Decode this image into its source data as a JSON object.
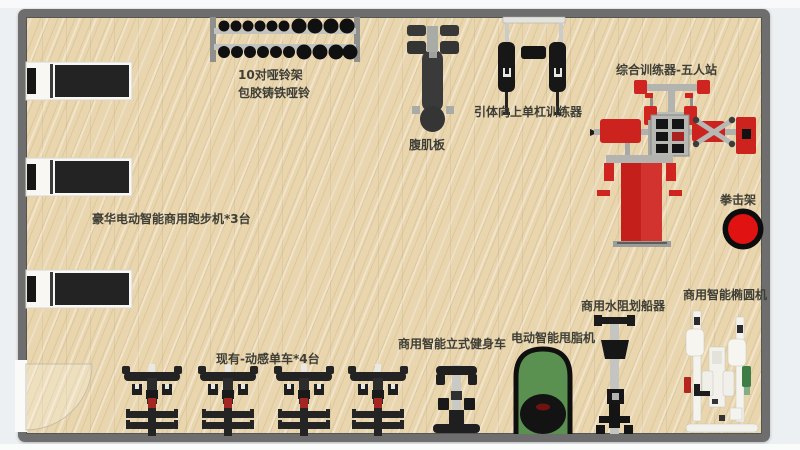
{
  "colors": {
    "floor": "#e9d6ae",
    "wall": "#6e6e6e",
    "machine_red": "#cc231f",
    "machine_green": "#5a9150",
    "machine_black": "#1a1a1a",
    "label_text": "#3e3e36",
    "outside": "#edf0f2"
  },
  "equipment": {
    "treadmills": {
      "label": "豪华电动智能商用跑步机*3台",
      "count": 3
    },
    "dumbbell_rack": {
      "label_line1": "10对哑铃架",
      "label_line2": "包胶铸铁哑铃",
      "pairs": 10
    },
    "ab_board": {
      "label": "腹肌板"
    },
    "pullup_trainer": {
      "label": "引体向上单杠训练器"
    },
    "multi_station": {
      "label": "综合训练器-五人站",
      "stations": 5
    },
    "boxing_rack": {
      "label": "拳击架"
    },
    "spin_bikes": {
      "label": "现有-动感单车*4台",
      "count": 4
    },
    "upright_bike": {
      "label": "商用智能立式健身车"
    },
    "fat_shaker": {
      "label": "电动智能甩脂机"
    },
    "rower": {
      "label": "商用水阻划船器"
    },
    "elliptical": {
      "label": "商用智能椭圆机"
    }
  }
}
